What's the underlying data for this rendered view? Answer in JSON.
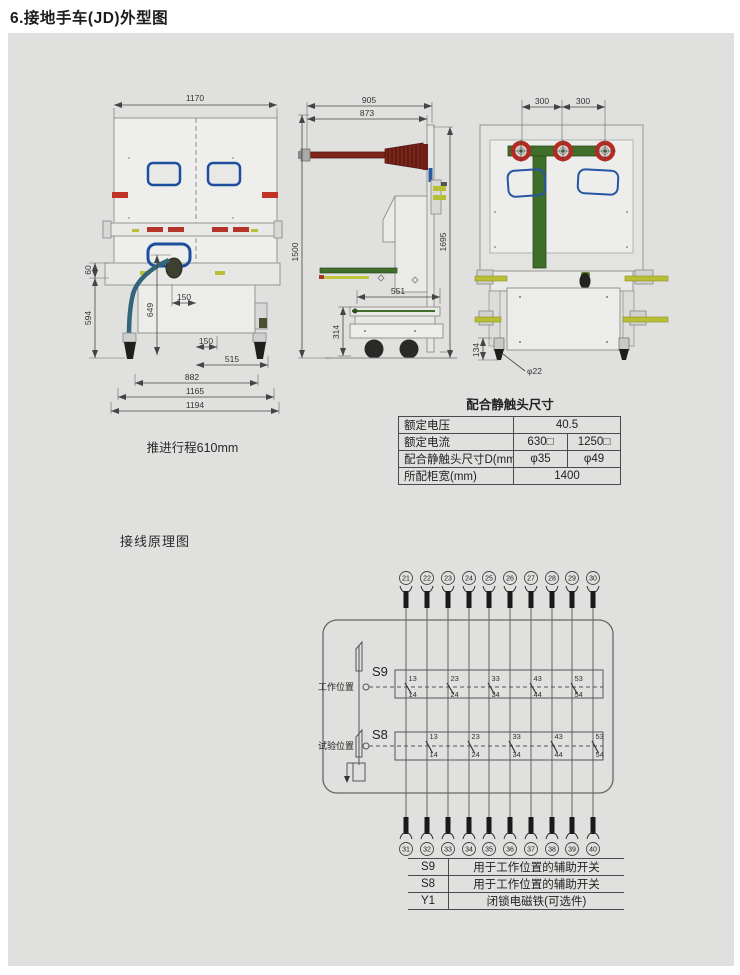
{
  "page_title": "6.接地手车(JD)外型图",
  "front_view": {
    "caption": "推进行程610mm",
    "dims": {
      "width_top": "1170",
      "h60": "60",
      "h594": "594",
      "h649": "649",
      "w150a": "150",
      "w150b": "150",
      "w515": "515",
      "w882": "882",
      "w1165": "1165",
      "w1194": "1194"
    }
  },
  "side_view": {
    "dims": {
      "w905": "905",
      "w873": "873",
      "h1500": "1500",
      "h1695": "1695",
      "w551": "551",
      "h314": "314"
    }
  },
  "rear_view": {
    "dims": {
      "w300a": "300",
      "w300b": "300",
      "h134": "134",
      "caster_dia": "φ22"
    }
  },
  "contact_table": {
    "title": "配合静触头尺寸",
    "rows": [
      {
        "label": "额定电压",
        "span": "40.5"
      },
      {
        "label": "额定电流",
        "v1": "630□",
        "v2": "1250□"
      },
      {
        "label": "配合静触头尺寸D(mm)",
        "v1": "φ35",
        "v2": "φ49"
      },
      {
        "label": "所配柜宽(mm)",
        "span": "1400"
      }
    ]
  },
  "schematic": {
    "title": "接线原理图",
    "top_terminals": [
      "21",
      "22",
      "23",
      "24",
      "25",
      "26",
      "27",
      "28",
      "29",
      "30"
    ],
    "bottom_terminals": [
      "31",
      "32",
      "33",
      "34",
      "35",
      "36",
      "37",
      "38",
      "39",
      "40"
    ],
    "switches": [
      {
        "name": "S9",
        "position": "工作位置",
        "contacts": [
          {
            "top": "13",
            "bottom": "14"
          },
          {
            "top": "23",
            "bottom": "24"
          },
          {
            "top": "33",
            "bottom": "34"
          },
          {
            "top": "43",
            "bottom": "44"
          },
          {
            "top": "53",
            "bottom": "54"
          }
        ]
      },
      {
        "name": "S8",
        "position": "试验位置",
        "contacts": [
          {
            "top": "13",
            "bottom": "14"
          },
          {
            "top": "23",
            "bottom": "24"
          },
          {
            "top": "33",
            "bottom": "34"
          },
          {
            "top": "43",
            "bottom": "44"
          },
          {
            "top": "53",
            "bottom": "54"
          }
        ]
      }
    ]
  },
  "legend": {
    "rows": [
      {
        "code": "S9",
        "desc": "用于工作位置的辅助开关"
      },
      {
        "code": "S8",
        "desc": "用于工作位置的辅助开关"
      },
      {
        "code": "Y1",
        "desc": "闭锁电磁铁(可选件)"
      }
    ]
  },
  "colors": {
    "panel_bg": "#e0e0de",
    "line": "#555555",
    "dim": "#444444",
    "red": "#b5342a",
    "blue": "#1d4f9e",
    "green": "#3f6d2a",
    "yellow_green": "#b9bf35",
    "insulator": "#7d241b"
  }
}
